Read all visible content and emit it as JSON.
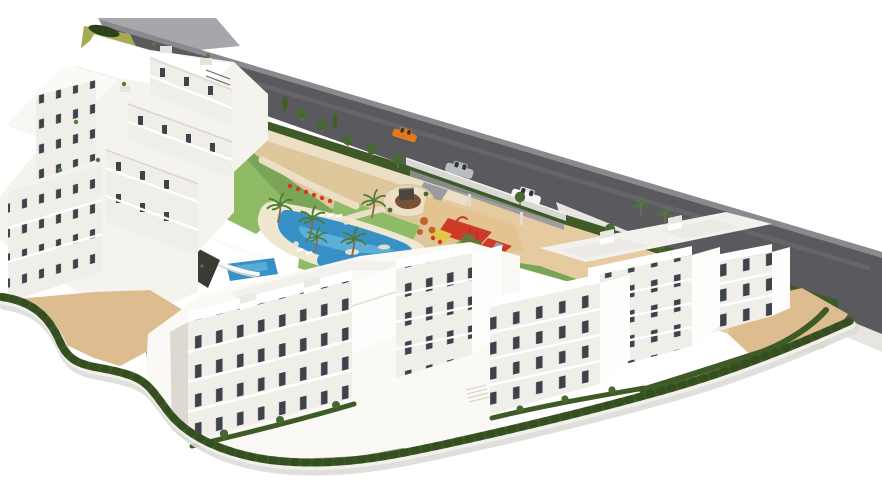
{
  "scene": {
    "type": "architectural-3d-render",
    "subject": "Aerial 3D render of a white Mediterranean apartment complex with communal lagoon pool, gardens, children's playground, terraced green slope and an access road with three cars",
    "canvas": {
      "width": 882,
      "height": 504
    },
    "palette": {
      "bg": "#ffffff",
      "road": "#5a595d",
      "roadEdge": "#8a8a8e",
      "platform": "#a7a7ab",
      "streak": "#6e6e72",
      "wallLight": "#e6e5e2",
      "driveway": "#9b9b9f",
      "sand": "#ddbd8f",
      "sandLight": "#e6cba1",
      "pathPink": "#ecdfc6",
      "playSand": "#e3c390",
      "grass": "#7aa557",
      "grassLight": "#8fbb67",
      "hedge": "#3e5a26",
      "hedgeDark": "#2c421a",
      "pool": "#3791c6",
      "poolLight": "#7ec7e8",
      "deck": "#efe7d0",
      "white": "#ffffff",
      "face": "#f0eee8",
      "faceShade": "#ded9d0",
      "bright": "#fdfdfc",
      "roofLight": "#f2f1ed",
      "window": "#3d424b",
      "mulch": "#7b5136",
      "signDark": "#4a453d",
      "playRed": "#cf3a28",
      "playYellow": "#e2c54a",
      "playGreen": "#7fae57",
      "carOrange": "#e0791f",
      "carSilver": "#b9bdc2",
      "carWhite": "#f5f5f5",
      "carShadow": "#4a4a4e",
      "palm": "#4f7c38",
      "tree": "#476831",
      "cypress": "#3f6029",
      "treeOrange": "#bc6530",
      "olive": "#5f7a3a",
      "trunk": "#8a6a4b",
      "rock": "#3b3a33",
      "ramp": "#a39d93",
      "hillOlive": "#a6aa52",
      "hillStep": "#5e7d37"
    },
    "inventory": {
      "road": {
        "orientation": "diagonal upper-left to right edge",
        "cars": [
          {
            "id": "car-orange",
            "color": "orange"
          },
          {
            "id": "car-silver",
            "color": "silver"
          },
          {
            "id": "car-white",
            "color": "white"
          }
        ]
      },
      "building_clusters": [
        {
          "id": "northwest-terraced-cluster",
          "style": "stepped white terraces",
          "floors": 4
        },
        {
          "id": "south-central-slabs",
          "style": "white slab blocks",
          "floors": 4
        },
        {
          "id": "east-cluster",
          "style": "white blocks with roof terraces",
          "floors": 4
        }
      ],
      "amenities": [
        "lagoon-pool",
        "kids-pool",
        "sun-loungers",
        "children-playground",
        "circular-plaza-with-sign",
        "entrance-canopy",
        "terraced-green-slope",
        "perimeter-hedge-and-wall",
        "palm-trees",
        "sand-courtyards"
      ],
      "palm_count": 10,
      "playground_colors": [
        "red",
        "green",
        "yellow"
      ]
    }
  }
}
